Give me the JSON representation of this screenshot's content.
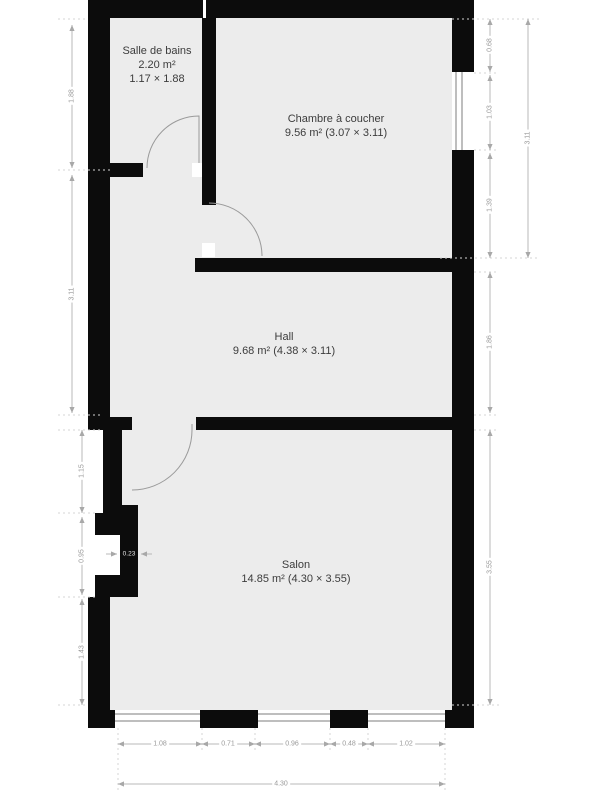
{
  "plan": {
    "title": "Floor plan",
    "rooms": [
      {
        "name": "Salle de bains",
        "area": "2.20 m²",
        "dims": "1.17 × 1.88"
      },
      {
        "name": "Chambre à coucher",
        "area_dims": "9.56 m² (3.07 × 3.11)"
      },
      {
        "name": "Hall",
        "area_dims": "9.68 m² (4.38 × 3.11)"
      },
      {
        "name": "Salon",
        "area_dims": "14.85 m² (4.30 × 3.55)"
      }
    ],
    "dimensions": {
      "left": [
        "1.88",
        "3.11",
        "1.15",
        "0.95",
        "1.43"
      ],
      "wall_step": "0.23",
      "right": [
        "0.68",
        "1.03",
        "1.39",
        "1.86",
        "3.55"
      ],
      "right_total": "3.11",
      "bottom": [
        "1.08",
        "0.71",
        "0.96",
        "0.48",
        "1.02"
      ],
      "bottom_total": "4.30"
    },
    "colors": {
      "wall": "#0c0c0c",
      "room_fill": "#ececec",
      "dimension_line": "#b8b8b8",
      "dimension_text": "#9a9a9a",
      "label_text": "#3c3c3c"
    }
  }
}
